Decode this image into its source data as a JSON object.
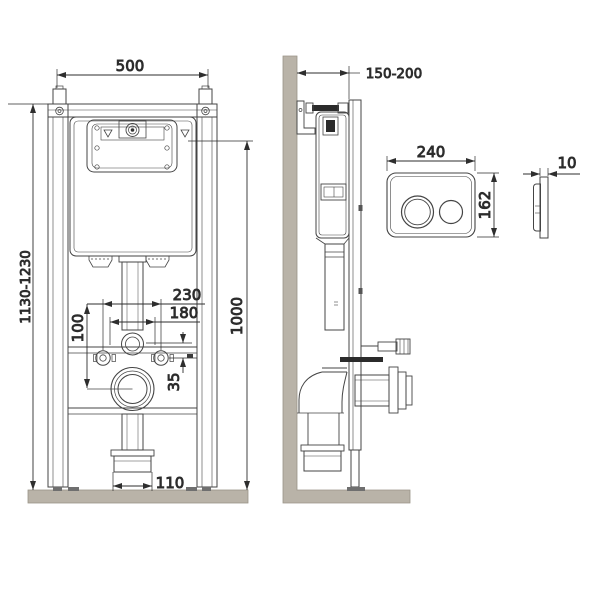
{
  "colors": {
    "line": "#444444",
    "dim_line": "#2e2e2e",
    "wall_fill": "#b9b3a8",
    "wall_edge": "#9a9488",
    "background": "#ffffff"
  },
  "front_view": {
    "dims": {
      "width": "500",
      "height_range": "1130-1230",
      "reference_height": "1000",
      "fixing_span_outer": "230",
      "fixing_span_inner": "180",
      "drain_center_offset": "100",
      "bolt_line_offset": "35",
      "outlet_width": "110"
    }
  },
  "side_view": {
    "dims": {
      "wall_distance_range": "150-200"
    }
  },
  "flush_plate_front": {
    "dims": {
      "width": "240",
      "height": "162"
    }
  },
  "flush_plate_side": {
    "dims": {
      "thickness": "10"
    }
  }
}
